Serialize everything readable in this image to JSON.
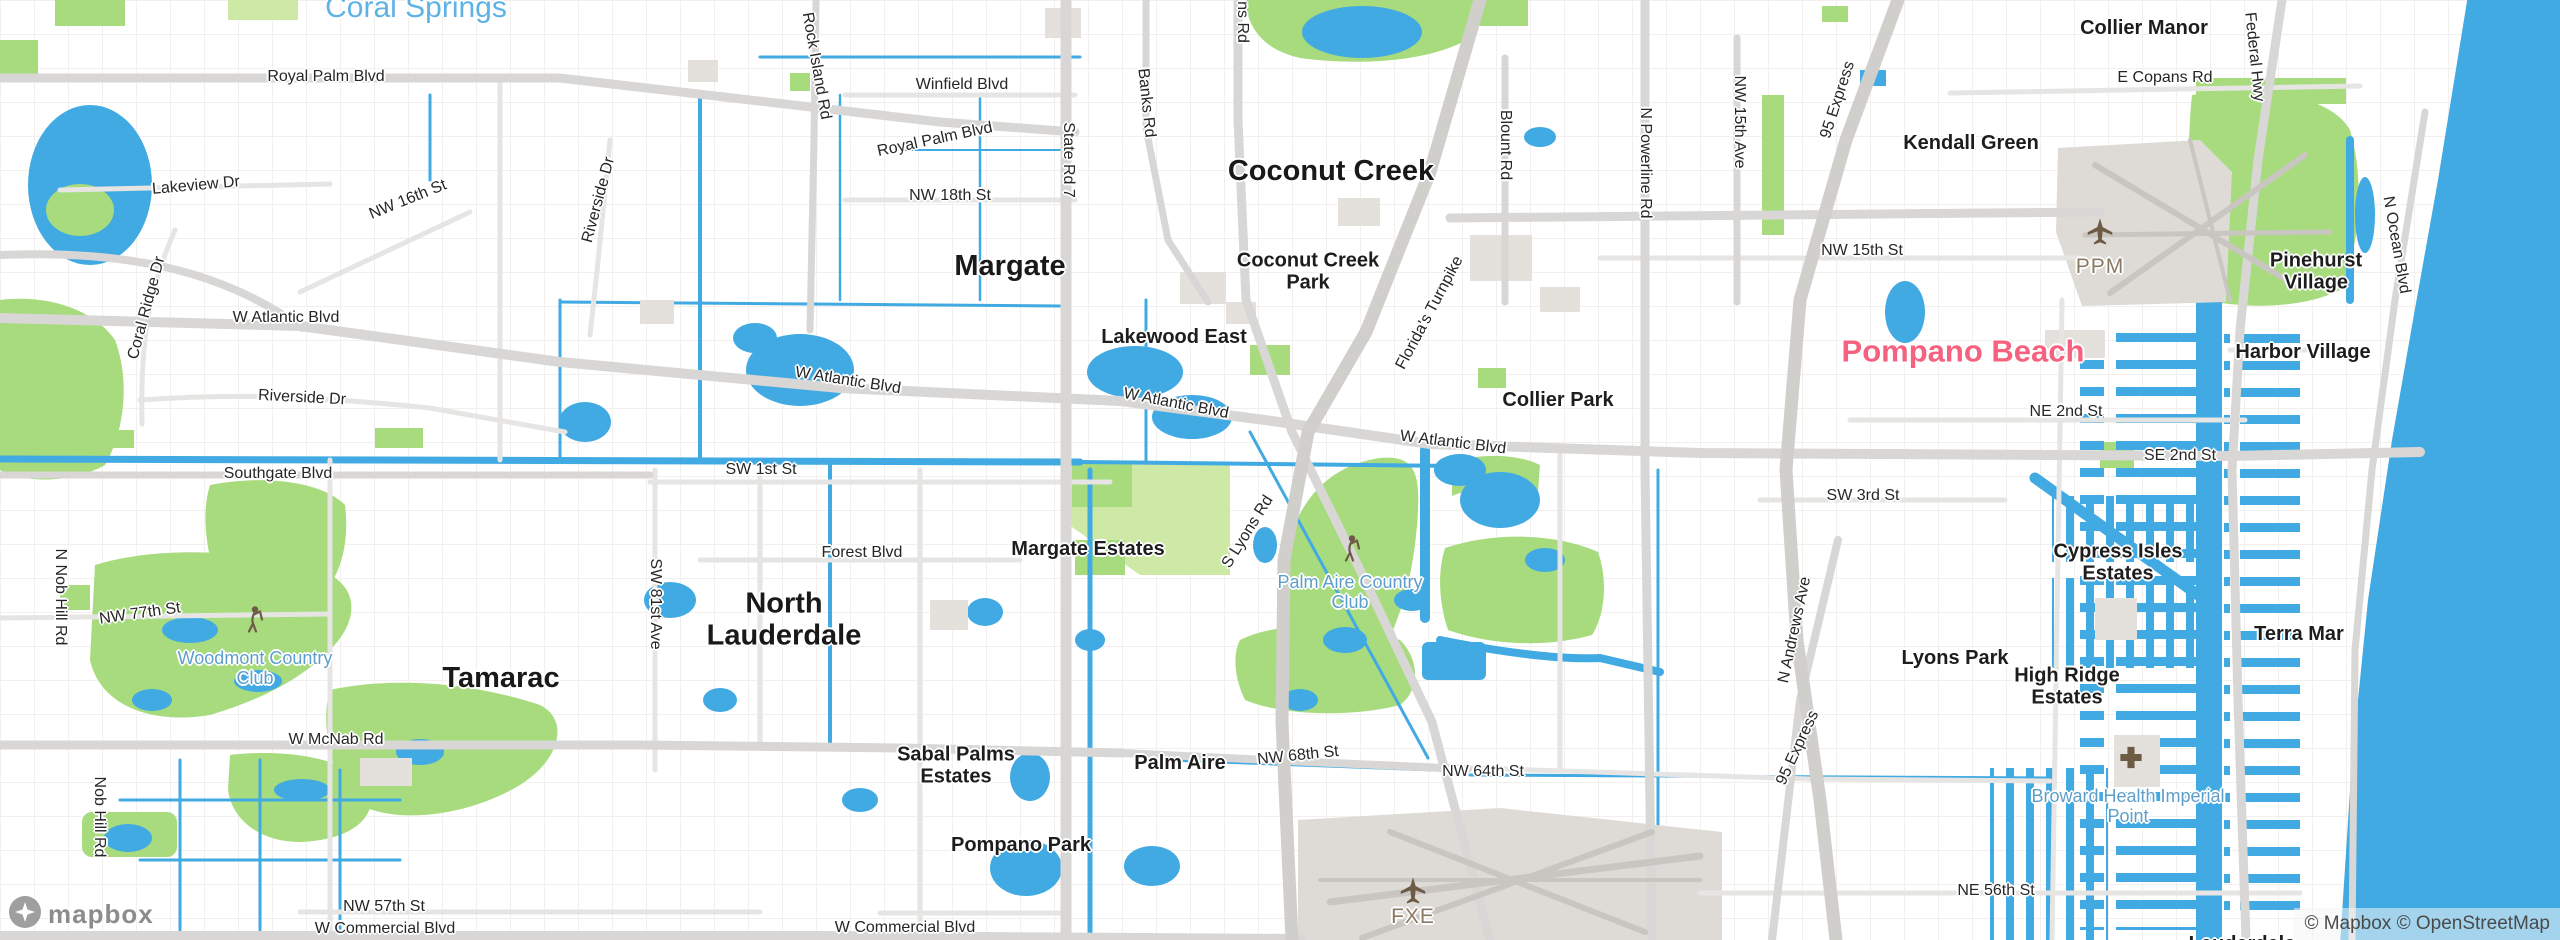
{
  "colors": {
    "water": "#41aae2",
    "park": "#a7db7d",
    "parkpale": "#cde9a5",
    "grid": "#efeeec",
    "roadminor": "#e6e5e3",
    "road": "#d8d7d5",
    "motorway": "#d1cfcc",
    "building": "#e4e1dd",
    "pink": "#f5617e",
    "bluecity": "#5fb2e6",
    "poilabel": "#5d9fc9",
    "airportlabel": "#8a7a64",
    "icon": "#6e5b45",
    "citytext": "#191919",
    "roadtext": "#262626",
    "attrtext": "#4a4a4a"
  },
  "map": {
    "watermark": "mapbox",
    "attribution": "© Mapbox © OpenStreetMap"
  },
  "labels": [
    {
      "n": "city-label-coral-springs",
      "t": "Coral Springs",
      "x": 416,
      "y": 8,
      "c": "cityfar"
    },
    {
      "n": "city-label-margate",
      "t": "Margate",
      "x": 1010,
      "y": 266,
      "c": "city"
    },
    {
      "n": "city-label-coconut-creek",
      "t": "Coconut Creek",
      "x": 1331,
      "y": 171,
      "c": "city"
    },
    {
      "n": "city-label-tamarac",
      "t": "Tamarac",
      "x": 501,
      "y": 678,
      "c": "city"
    },
    {
      "n": "city-label-north-lauderdale",
      "t": "North Lauderdale",
      "x": 784,
      "y": 620,
      "c": "city",
      "w": 210
    },
    {
      "n": "city-label-pompano-beach",
      "t": "Pompano Beach",
      "x": 1963,
      "y": 352,
      "c": "citypink"
    },
    {
      "n": "place-label-kendall-green",
      "t": "Kendall Green",
      "x": 1971,
      "y": 143,
      "c": "place"
    },
    {
      "n": "place-label-collier-manor",
      "t": "Collier Manor",
      "x": 2144,
      "y": 28,
      "c": "place"
    },
    {
      "n": "place-label-pinehurst-village",
      "t": "Pinehurst Village",
      "x": 2316,
      "y": 272,
      "c": "place",
      "w": 120
    },
    {
      "n": "place-label-harbor-village",
      "t": "Harbor Village",
      "x": 2303,
      "y": 352,
      "c": "place"
    },
    {
      "n": "place-label-lakewood-east",
      "t": "Lakewood East",
      "x": 1174,
      "y": 337,
      "c": "place"
    },
    {
      "n": "place-label-collier-park",
      "t": "Collier Park",
      "x": 1558,
      "y": 400,
      "c": "place"
    },
    {
      "n": "place-label-margate-estates",
      "t": "Margate Estates",
      "x": 1088,
      "y": 549,
      "c": "place"
    },
    {
      "n": "place-label-lyons-park",
      "t": "Lyons Park",
      "x": 1955,
      "y": 658,
      "c": "place"
    },
    {
      "n": "place-label-high-ridge-estates",
      "t": "High Ridge Estates",
      "x": 2067,
      "y": 687,
      "c": "place",
      "w": 150
    },
    {
      "n": "place-label-terra-mar",
      "t": "Terra Mar",
      "x": 2299,
      "y": 634,
      "c": "place"
    },
    {
      "n": "place-label-cypress-isles-estates",
      "t": "Cypress Isles Estates",
      "x": 2118,
      "y": 563,
      "c": "place",
      "w": 165
    },
    {
      "n": "place-label-sabal-palms-estates",
      "t": "Sabal Palms Estates",
      "x": 956,
      "y": 766,
      "c": "place",
      "w": 165
    },
    {
      "n": "place-label-palm-aire",
      "t": "Palm Aire",
      "x": 1180,
      "y": 763,
      "c": "place"
    },
    {
      "n": "place-label-pompano-park",
      "t": "Pompano Park",
      "x": 1021,
      "y": 845,
      "c": "place"
    },
    {
      "n": "place-label-coconut-creek-park",
      "t": "Coconut Creek Park",
      "x": 1308,
      "y": 272,
      "c": "place",
      "w": 155
    },
    {
      "n": "place-label-lauderdale",
      "t": "Lauderdale",
      "x": 2242,
      "y": 944,
      "c": "place"
    },
    {
      "n": "road-label-royal-palm-blvd-w",
      "t": "Royal Palm Blvd",
      "x": 326,
      "y": 77,
      "c": "road"
    },
    {
      "n": "road-label-royal-palm-blvd-e",
      "t": "Royal Palm Blvd",
      "x": 935,
      "y": 140,
      "c": "road",
      "r": -12
    },
    {
      "n": "road-label-winfield-blvd",
      "t": "Winfield Blvd",
      "x": 962,
      "y": 85,
      "c": "road"
    },
    {
      "n": "road-label-nw-18th-st",
      "t": "NW 18th St",
      "x": 950,
      "y": 196,
      "c": "road"
    },
    {
      "n": "road-label-nw-16th-st",
      "t": "NW 16th St",
      "x": 408,
      "y": 200,
      "c": "road",
      "r": -22
    },
    {
      "n": "road-label-lakeview-dr",
      "t": "Lakeview Dr",
      "x": 196,
      "y": 186,
      "c": "road",
      "r": -5
    },
    {
      "n": "road-label-w-atlantic-blvd-1",
      "t": "W Atlantic Blvd",
      "x": 286,
      "y": 318,
      "c": "road"
    },
    {
      "n": "road-label-w-atlantic-blvd-2",
      "t": "W Atlantic Blvd",
      "x": 848,
      "y": 381,
      "c": "road",
      "r": 9
    },
    {
      "n": "road-label-w-atlantic-blvd-3",
      "t": "W Atlantic Blvd",
      "x": 1176,
      "y": 404,
      "c": "road",
      "r": 11
    },
    {
      "n": "road-label-w-atlantic-blvd-4",
      "t": "W Atlantic Blvd",
      "x": 1453,
      "y": 443,
      "c": "road",
      "r": 7
    },
    {
      "n": "road-label-riverside-dr-s",
      "t": "Riverside Dr",
      "x": 302,
      "y": 398,
      "c": "road",
      "r": 3
    },
    {
      "n": "road-label-southgate-blvd",
      "t": "Southgate Blvd",
      "x": 278,
      "y": 474,
      "c": "road"
    },
    {
      "n": "road-label-sw-1st-st",
      "t": "SW 1st St",
      "x": 761,
      "y": 470,
      "c": "road"
    },
    {
      "n": "road-label-forest-blvd",
      "t": "Forest Blvd",
      "x": 862,
      "y": 553,
      "c": "road"
    },
    {
      "n": "road-label-nw-77th-st",
      "t": "NW 77th St",
      "x": 140,
      "y": 614,
      "c": "road",
      "r": -8
    },
    {
      "n": "road-label-w-mcnab-rd",
      "t": "W McNab Rd",
      "x": 336,
      "y": 740,
      "c": "road"
    },
    {
      "n": "road-label-nw-57th-st",
      "t": "NW 57th St",
      "x": 384,
      "y": 907,
      "c": "road"
    },
    {
      "n": "road-label-w-commercial-blvd-w",
      "t": "W Commercial Blvd",
      "x": 385,
      "y": 929,
      "c": "road"
    },
    {
      "n": "road-label-w-commercial-blvd-e",
      "t": "W Commercial Blvd",
      "x": 905,
      "y": 928,
      "c": "road"
    },
    {
      "n": "road-label-nw-68th-st",
      "t": "NW 68th St",
      "x": 1298,
      "y": 756,
      "c": "road",
      "r": -6
    },
    {
      "n": "road-label-nw-64th-st",
      "t": "NW 64th St",
      "x": 1483,
      "y": 772,
      "c": "road"
    },
    {
      "n": "road-label-ne-56th-st",
      "t": "NE 56th St",
      "x": 1996,
      "y": 891,
      "c": "road"
    },
    {
      "n": "road-label-ne-2nd-st",
      "t": "NE 2nd St",
      "x": 2066,
      "y": 412,
      "c": "road"
    },
    {
      "n": "road-label-se-2nd-st",
      "t": "SE 2nd St",
      "x": 2180,
      "y": 456,
      "c": "road"
    },
    {
      "n": "road-label-sw-3rd-st",
      "t": "SW 3rd St",
      "x": 1863,
      "y": 496,
      "c": "road"
    },
    {
      "n": "road-label-rock-island-rd",
      "t": "Rock Island Rd",
      "x": 816,
      "y": 66,
      "c": "road",
      "r": 80
    },
    {
      "n": "road-label-state-rd-7",
      "t": "State Rd 7",
      "x": 1068,
      "y": 160,
      "c": "road",
      "r": 90
    },
    {
      "n": "road-label-banks-rd",
      "t": "Banks Rd",
      "x": 1146,
      "y": 103,
      "c": "road",
      "r": 84
    },
    {
      "n": "road-label-lyons-rd-partial",
      "t": "ns Rd",
      "x": 1242,
      "y": 22,
      "c": "road",
      "r": 90
    },
    {
      "n": "road-label-s-lyons-rd",
      "t": "S Lyons Rd",
      "x": 1248,
      "y": 532,
      "c": "road",
      "r": -58
    },
    {
      "n": "road-label-floridas-turnpike",
      "t": "Florida's Turnpike",
      "x": 1430,
      "y": 313,
      "c": "road",
      "r": -62
    },
    {
      "n": "road-label-blount-rd",
      "t": "Blount Rd",
      "x": 1505,
      "y": 145,
      "c": "road",
      "r": 90
    },
    {
      "n": "road-label-n-powerline-rd",
      "t": "N Powerline Rd",
      "x": 1645,
      "y": 163,
      "c": "road",
      "r": 90
    },
    {
      "n": "road-label-nw-15th-ave",
      "t": "NW 15th Ave",
      "x": 1739,
      "y": 122,
      "c": "road",
      "r": 90
    },
    {
      "n": "road-label-95-express-n",
      "t": "95 Express",
      "x": 1838,
      "y": 100,
      "c": "road",
      "r": -72
    },
    {
      "n": "road-label-nw-15th-st",
      "t": "NW 15th St",
      "x": 1862,
      "y": 251,
      "c": "road"
    },
    {
      "n": "road-label-e-copans-rd",
      "t": "E Copans Rd",
      "x": 2165,
      "y": 78,
      "c": "road"
    },
    {
      "n": "road-label-federal-hwy",
      "t": "Federal Hwy",
      "x": 2254,
      "y": 57,
      "c": "road",
      "r": 84
    },
    {
      "n": "road-label-n-ocean-blvd",
      "t": "N Ocean Blvd",
      "x": 2396,
      "y": 245,
      "c": "road",
      "r": 80
    },
    {
      "n": "road-label-n-andrews-ave",
      "t": "N Andrews Ave",
      "x": 1795,
      "y": 630,
      "c": "road",
      "r": -78
    },
    {
      "n": "road-label-95-express-s",
      "t": "95 Express",
      "x": 1798,
      "y": 748,
      "c": "road",
      "r": -65
    },
    {
      "n": "road-label-sw-81st-ave",
      "t": "SW 81st Ave",
      "x": 655,
      "y": 604,
      "c": "road",
      "r": 90
    },
    {
      "n": "road-label-nob-hill-rd",
      "t": "Nob Hill Rd",
      "x": 99,
      "y": 817,
      "c": "road",
      "r": 90
    },
    {
      "n": "road-label-n-nob-hill-rd",
      "t": "N Nob Hill Rd",
      "x": 60,
      "y": 597,
      "c": "road",
      "r": 90
    },
    {
      "n": "road-label-riverside-dr-n",
      "t": "Riverside Dr",
      "x": 599,
      "y": 200,
      "c": "road",
      "r": -75
    },
    {
      "n": "road-label-coral-ridge-dr",
      "t": "Coral Ridge Dr",
      "x": 147,
      "y": 308,
      "c": "road",
      "r": -75
    },
    {
      "n": "poi-label-woodmont-country-club",
      "t": "Woodmont Country Club",
      "x": 255,
      "y": 668,
      "c": "poi",
      "w": 160
    },
    {
      "n": "poi-label-palm-aire-country-club",
      "t": "Palm Aire Country Club",
      "x": 1350,
      "y": 592,
      "c": "poi",
      "w": 160
    },
    {
      "n": "poi-label-broward-health-imperial-point",
      "t": "Broward Health Imperial Point",
      "x": 2128,
      "y": 806,
      "c": "poi",
      "w": 220
    },
    {
      "n": "airport-label-ppm",
      "t": "PPM",
      "x": 2100,
      "y": 267,
      "c": "airport"
    },
    {
      "n": "airport-label-fxe",
      "t": "FXE",
      "x": 1413,
      "y": 917,
      "c": "airport"
    }
  ]
}
